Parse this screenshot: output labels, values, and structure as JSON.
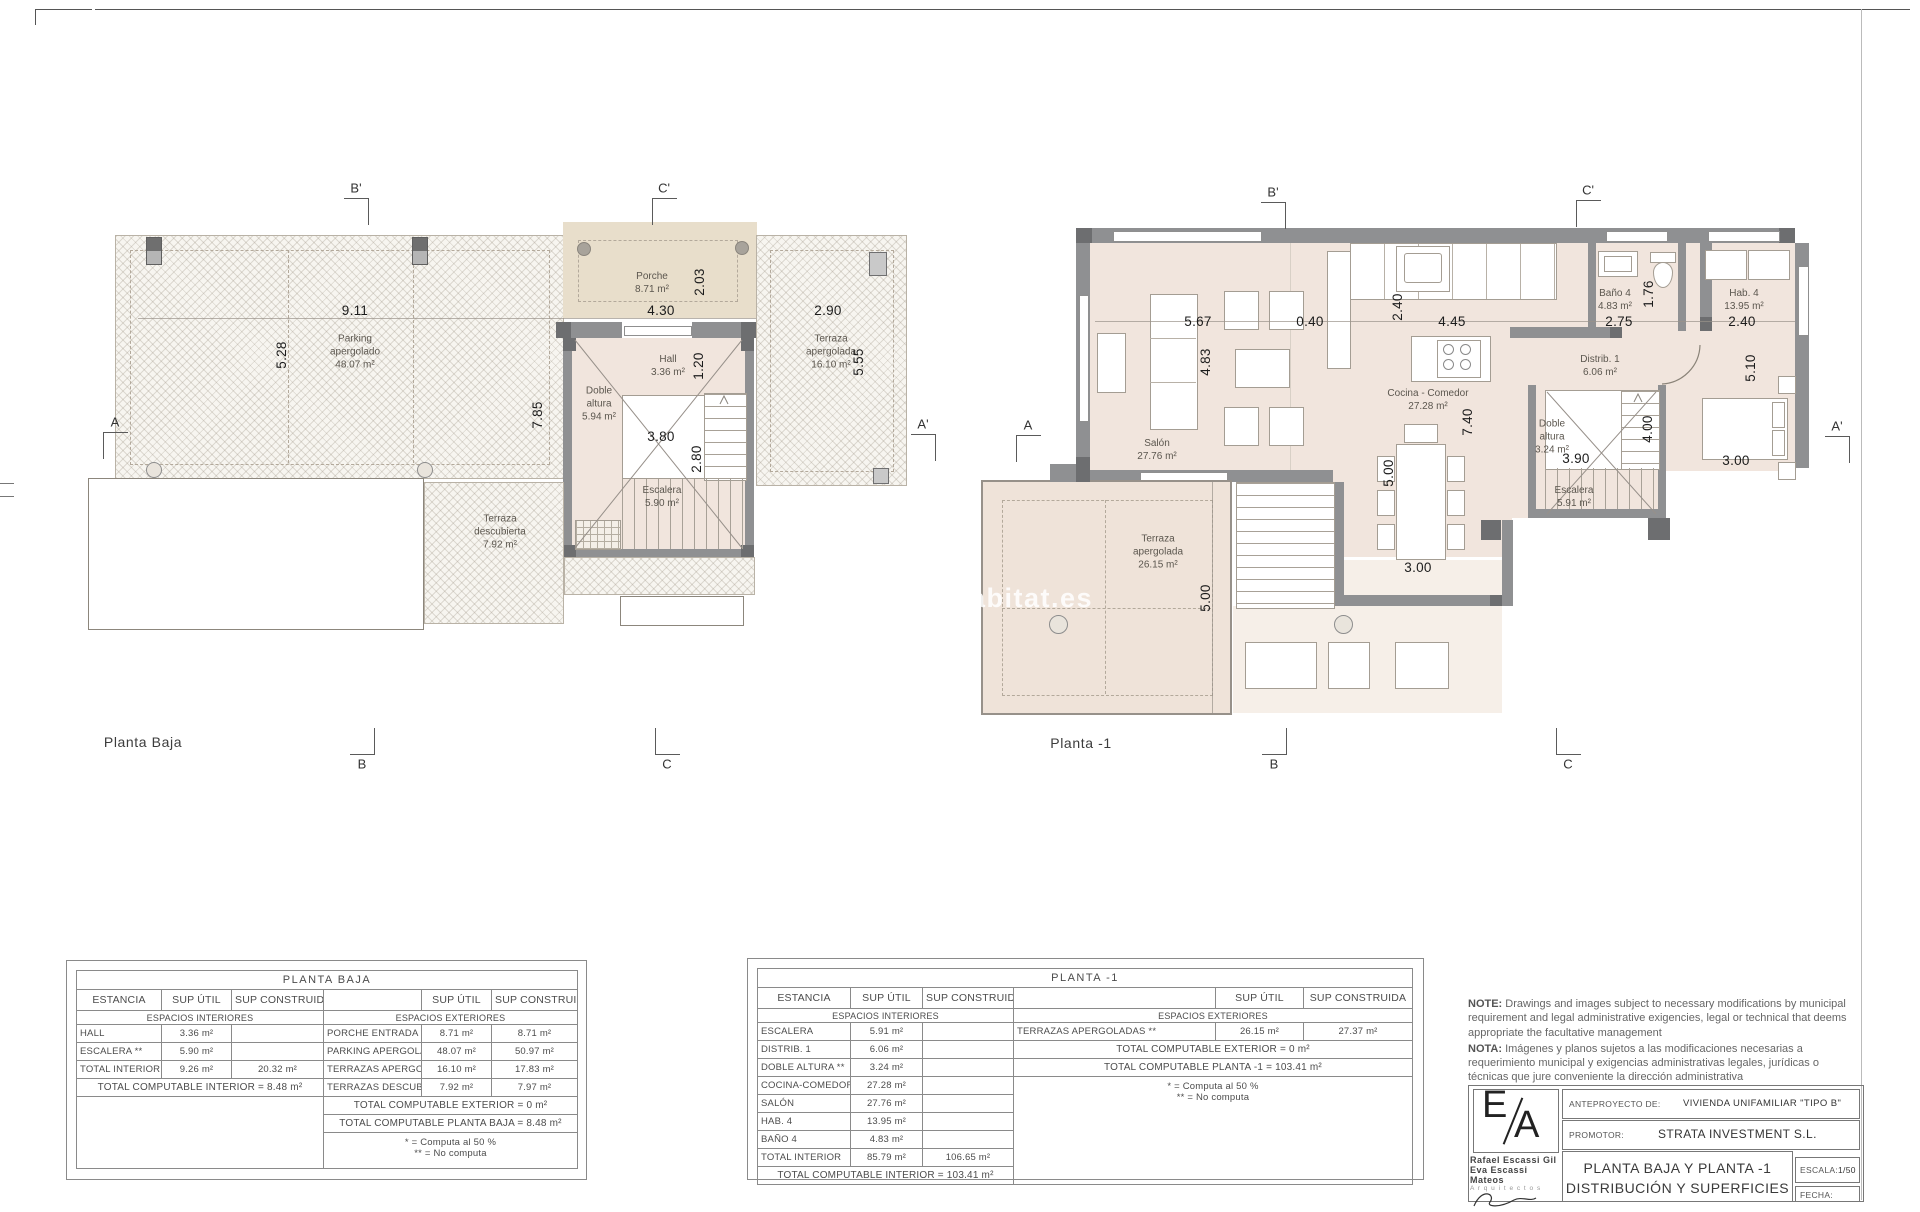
{
  "sheet": {
    "watermark": "habitat.es",
    "notes": {
      "en_label": "NOTE:",
      "en_text": " Drawings and images subject to necessary modifications by municipal requirement and legal administrative exigencies, legal or technical that deems appropriate the facultative management",
      "es_label": "NOTA:",
      "es_text": " Imágenes y planos sujetos a las modificaciones necesarias a requerimiento municipal y exigencias administrativas legales, jurídicas o técnicas que jure conveniente la dirección administrativa"
    },
    "titleblock": {
      "logo_e": "E",
      "logo_a": "A",
      "architect1": "Rafael Escassi Gil",
      "architect2": "Eva Escassi Mateos",
      "architects_word": "A r q u i t e c t o s",
      "anteproyecto_label": "ANTEPROYECTO DE:",
      "anteproyecto_value": "VIVIENDA UNIFAMILIAR \"TIPO B\"",
      "promotor_label": "PROMOTOR:",
      "promotor_value": "STRATA INVESTMENT S.L.",
      "sheet_title_1": "PLANTA BAJA Y PLANTA -1",
      "sheet_title_2": "DISTRIBUCIÓN Y SUPERFICIES",
      "escala_label": "ESCALA:",
      "escala_value": "1/50",
      "fecha_label": "FECHA:"
    }
  },
  "plans": {
    "left_title": "Planta Baja",
    "right_title": "Planta -1",
    "rooms": [
      {
        "t": "Parking\napergolado\n48.07 m²",
        "x": 355,
        "y": 352
      },
      {
        "t": "Porche\n8.71 m²",
        "x": 652,
        "y": 283
      },
      {
        "t": "Hall\n3.36 m²",
        "x": 668,
        "y": 366
      },
      {
        "t": "Doble\naltura\n5.94 m²",
        "x": 599,
        "y": 404
      },
      {
        "t": "Escalera\n5.90 m²",
        "x": 662,
        "y": 497
      },
      {
        "t": "Terraza\napergolada\n16.10 m²",
        "x": 831,
        "y": 352
      },
      {
        "t": "Terraza\ndescubierta\n7.92 m²",
        "x": 500,
        "y": 532
      },
      {
        "t": "Salón\n27.76 m²",
        "x": 1157,
        "y": 450
      },
      {
        "t": "Cocina - Comedor\n27.28 m²",
        "x": 1428,
        "y": 400
      },
      {
        "t": "Distrib. 1\n6.06 m²",
        "x": 1600,
        "y": 366
      },
      {
        "t": "Doble\naltura\n3.24 m²",
        "x": 1552,
        "y": 437
      },
      {
        "t": "Escalera\n5.91 m²",
        "x": 1574,
        "y": 497
      },
      {
        "t": "Baño 4\n4.83 m²",
        "x": 1615,
        "y": 300
      },
      {
        "t": "Hab. 4\n13.95 m²",
        "x": 1744,
        "y": 300
      },
      {
        "t": "Terraza\napergolada\n26.15 m²",
        "x": 1158,
        "y": 552
      }
    ],
    "dims": [
      {
        "t": "9.11",
        "x": 355,
        "y": 311
      },
      {
        "t": "5.28",
        "x": 282,
        "y": 355,
        "r": 1
      },
      {
        "t": "4.30",
        "x": 661,
        "y": 311
      },
      {
        "t": "2.03",
        "x": 700,
        "y": 282,
        "r": 1
      },
      {
        "t": "2.90",
        "x": 828,
        "y": 311
      },
      {
        "t": "5.55",
        "x": 859,
        "y": 362,
        "r": 1
      },
      {
        "t": "7.85",
        "x": 538,
        "y": 415,
        "r": 1
      },
      {
        "t": "1.20",
        "x": 699,
        "y": 366,
        "r": 1
      },
      {
        "t": "3.80",
        "x": 661,
        "y": 437
      },
      {
        "t": "2.80",
        "x": 697,
        "y": 459,
        "r": 1
      },
      {
        "t": "5.67",
        "x": 1198,
        "y": 322
      },
      {
        "t": "0.40",
        "x": 1310,
        "y": 322
      },
      {
        "t": "2.40",
        "x": 1398,
        "y": 307,
        "r": 1
      },
      {
        "t": "4.45",
        "x": 1452,
        "y": 322
      },
      {
        "t": "4.83",
        "x": 1206,
        "y": 362,
        "r": 1
      },
      {
        "t": "7.40",
        "x": 1468,
        "y": 422,
        "r": 1
      },
      {
        "t": "2.75",
        "x": 1619,
        "y": 322
      },
      {
        "t": "1.76",
        "x": 1649,
        "y": 294,
        "r": 1
      },
      {
        "t": "2.40",
        "x": 1742,
        "y": 322
      },
      {
        "t": "5.10",
        "x": 1751,
        "y": 368,
        "r": 1
      },
      {
        "t": "3.00",
        "x": 1736,
        "y": 461
      },
      {
        "t": "3.90",
        "x": 1576,
        "y": 459
      },
      {
        "t": "4.00",
        "x": 1648,
        "y": 429,
        "r": 1
      },
      {
        "t": "5.00",
        "x": 1389,
        "y": 473,
        "r": 1
      },
      {
        "t": "3.00",
        "x": 1418,
        "y": 568
      },
      {
        "t": "5.00",
        "x": 1206,
        "y": 598,
        "r": 1
      }
    ],
    "marks": [
      {
        "t": "B'",
        "x": 344,
        "y": 198,
        "e": "tr"
      },
      {
        "t": "C'",
        "x": 652,
        "y": 198,
        "e": "tl"
      },
      {
        "t": "A",
        "x": 103,
        "y": 432,
        "e": "tl"
      },
      {
        "t": "A'",
        "x": 911,
        "y": 434,
        "e": "tr"
      },
      {
        "t": "B",
        "x": 350,
        "y": 728,
        "e": "br"
      },
      {
        "t": "C",
        "x": 655,
        "y": 728,
        "e": "bl"
      },
      {
        "t": "B'",
        "x": 1261,
        "y": 202,
        "e": "tr"
      },
      {
        "t": "C'",
        "x": 1576,
        "y": 200,
        "e": "tl"
      },
      {
        "t": "A",
        "x": 1016,
        "y": 435,
        "e": "tl"
      },
      {
        "t": "A'",
        "x": 1825,
        "y": 436,
        "e": "tr"
      },
      {
        "t": "B",
        "x": 1262,
        "y": 728,
        "e": "br"
      },
      {
        "t": "C",
        "x": 1556,
        "y": 728,
        "e": "bl"
      }
    ]
  },
  "tables": [
    {
      "name": "planta-baja",
      "cols": [
        85,
        70,
        92,
        98,
        70,
        86
      ],
      "rows": [
        [
          {
            "t": "PLANTA BAJA",
            "cs": 6,
            "c": "t-title"
          }
        ],
        [
          {
            "t": "ESTANCIA",
            "c": "t-hdr"
          },
          {
            "t": "SUP ÚTIL",
            "c": "t-hdr"
          },
          {
            "t": "SUP CONSTRUIDA",
            "c": "t-hdr"
          },
          {
            "t": "",
            "c": "t-hdr"
          },
          {
            "t": "SUP ÚTIL",
            "c": "t-hdr"
          },
          {
            "t": "SUP CONSTRUIDA",
            "c": "t-hdr"
          }
        ],
        [
          {
            "t": "ESPACIOS INTERIORES",
            "cs": 3,
            "c": "t-sec"
          },
          {
            "t": "ESPACIOS EXTERIORES",
            "cs": 3,
            "c": "t-sec"
          }
        ],
        [
          {
            "t": "HALL",
            "c": "t-lbl"
          },
          {
            "t": "3.36 m²"
          },
          {
            "t": ""
          },
          {
            "t": "PORCHE ENTRADA **",
            "c": "t-lbl"
          },
          {
            "t": "8.71 m²"
          },
          {
            "t": "8.71 m²"
          }
        ],
        [
          {
            "t": "ESCALERA **",
            "c": "t-lbl"
          },
          {
            "t": "5.90 m²"
          },
          {
            "t": ""
          },
          {
            "t": "PARKING APERGOLADO **",
            "c": "t-lbl"
          },
          {
            "t": "48.07 m²"
          },
          {
            "t": "50.97 m²"
          }
        ],
        [
          {
            "t": "TOTAL INTERIOR",
            "c": "t-lbl"
          },
          {
            "t": "9.26 m²"
          },
          {
            "t": "20.32 m²"
          },
          {
            "t": "TERRAZAS APERGOLADAS **",
            "c": "t-lbl"
          },
          {
            "t": "16.10 m²"
          },
          {
            "t": "17.83 m²"
          }
        ],
        [
          {
            "t": "TOTAL COMPUTABLE INTERIOR = 8.48 m²",
            "cs": 3,
            "c": "t-total"
          },
          {
            "t": "TERRAZAS DESCUBIERTAS **",
            "c": "t-lbl"
          },
          {
            "t": "7.92 m²"
          },
          {
            "t": "7.97 m²"
          }
        ],
        [
          {
            "t": "",
            "cs": 3,
            "rs": 3,
            "c": "t-blank"
          },
          {
            "t": "TOTAL COMPUTABLE EXTERIOR = 0 m²",
            "cs": 3,
            "c": "t-total"
          }
        ],
        [
          {
            "t": "TOTAL COMPUTABLE PLANTA BAJA = 8.48 m²",
            "cs": 3,
            "c": "t-total"
          }
        ],
        [
          {
            "t": "* = Computa al 50 %\n** = No computa",
            "cs": 3,
            "c": "t-note"
          }
        ]
      ]
    },
    {
      "name": "planta-menos-1",
      "cols": [
        93,
        72,
        91,
        202,
        88,
        109
      ],
      "rows": [
        [
          {
            "t": "PLANTA  -1",
            "cs": 6,
            "c": "t-title"
          }
        ],
        [
          {
            "t": "ESTANCIA",
            "c": "t-hdr"
          },
          {
            "t": "SUP ÚTIL",
            "c": "t-hdr"
          },
          {
            "t": "SUP CONSTRUIDA",
            "c": "t-hdr"
          },
          {
            "t": "",
            "c": "t-hdr"
          },
          {
            "t": "SUP ÚTIL",
            "c": "t-hdr"
          },
          {
            "t": "SUP CONSTRUIDA",
            "c": "t-hdr"
          }
        ],
        [
          {
            "t": "ESPACIOS INTERIORES",
            "cs": 3,
            "c": "t-sec"
          },
          {
            "t": "ESPACIOS EXTERIORES",
            "cs": 3,
            "c": "t-sec"
          }
        ],
        [
          {
            "t": "ESCALERA",
            "c": "t-lbl"
          },
          {
            "t": "5.91 m²"
          },
          {
            "t": ""
          },
          {
            "t": "TERRAZAS APERGOLADAS **",
            "c": "t-lbl"
          },
          {
            "t": "26.15 m²"
          },
          {
            "t": "27.37 m²"
          }
        ],
        [
          {
            "t": "DISTRIB. 1",
            "c": "t-lbl"
          },
          {
            "t": "6.06 m²"
          },
          {
            "t": ""
          },
          {
            "t": "TOTAL COMPUTABLE EXTERIOR = 0 m²",
            "cs": 3,
            "c": "t-total"
          }
        ],
        [
          {
            "t": "DOBLE ALTURA **",
            "c": "t-lbl"
          },
          {
            "t": "3.24 m²"
          },
          {
            "t": ""
          },
          {
            "t": "TOTAL COMPUTABLE PLANTA -1 = 103.41 m²",
            "cs": 3,
            "c": "t-total"
          }
        ],
        [
          {
            "t": "COCINA-COMEDOR",
            "c": "t-lbl"
          },
          {
            "t": "27.28 m²"
          },
          {
            "t": ""
          },
          {
            "t": "* = Computa al 50 %\n** = No computa",
            "cs": 3,
            "rs": 6,
            "c": "t-note"
          }
        ],
        [
          {
            "t": "SALÓN",
            "c": "t-lbl"
          },
          {
            "t": "27.76 m²"
          },
          {
            "t": ""
          }
        ],
        [
          {
            "t": "HAB. 4",
            "c": "t-lbl"
          },
          {
            "t": "13.95 m²"
          },
          {
            "t": ""
          }
        ],
        [
          {
            "t": "BAÑO 4",
            "c": "t-lbl"
          },
          {
            "t": "4.83 m²"
          },
          {
            "t": ""
          }
        ],
        [
          {
            "t": "TOTAL INTERIOR",
            "c": "t-lbl"
          },
          {
            "t": "85.79 m²"
          },
          {
            "t": "106.65 m²"
          }
        ],
        [
          {
            "t": "TOTAL COMPUTABLE INTERIOR = 103.41 m²",
            "cs": 3,
            "c": "t-total"
          }
        ]
      ]
    }
  ]
}
